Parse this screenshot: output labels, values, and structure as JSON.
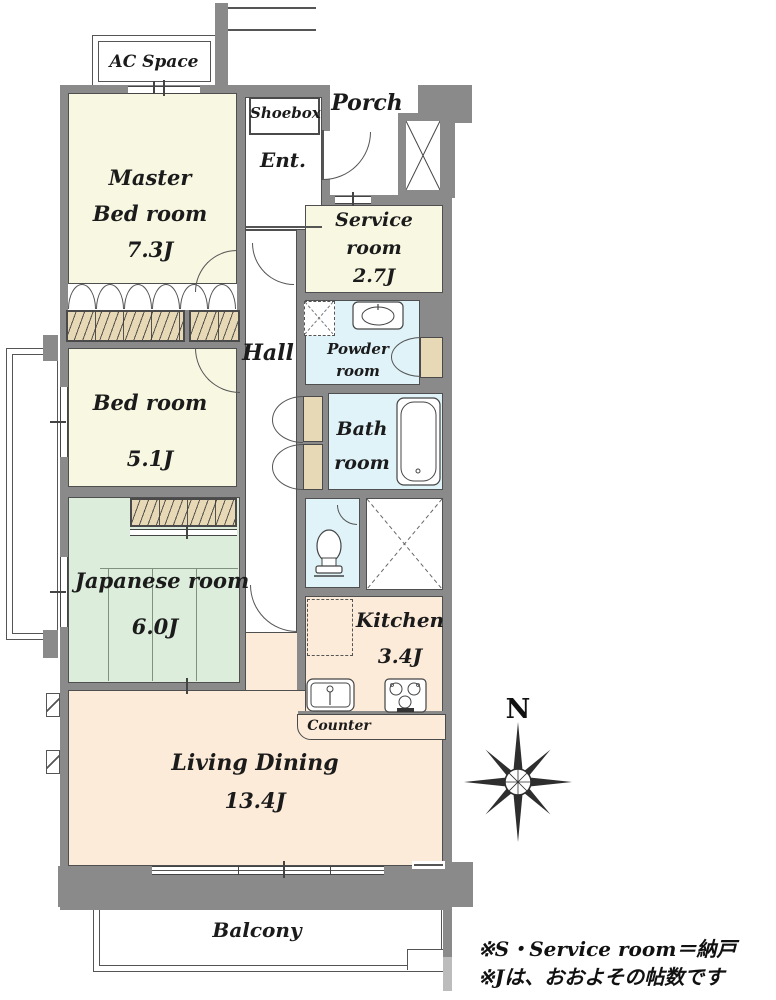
{
  "rooms": {
    "ac_space": {
      "name": "AC Space"
    },
    "master_bedroom": {
      "name_lines": [
        "Master",
        "Bed room"
      ],
      "area": "7.3J"
    },
    "shoebox": {
      "name": "Shoebox"
    },
    "entrance": {
      "name": "Ent."
    },
    "porch": {
      "name": "Porch"
    },
    "service_room": {
      "name_lines": [
        "Service",
        "room"
      ],
      "area": "2.7J"
    },
    "hall": {
      "name": "Hall"
    },
    "powder_room": {
      "name_lines": [
        "Powder",
        "room"
      ]
    },
    "bath_room": {
      "name_lines": [
        "Bath",
        "room"
      ]
    },
    "bedroom": {
      "name": "Bed room",
      "area": "5.1J"
    },
    "japanese_room": {
      "name": "Japanese room",
      "area": "6.0J"
    },
    "kitchen": {
      "name": "Kitchen",
      "area": "3.4J"
    },
    "counter": {
      "name": "Counter"
    },
    "living_dining": {
      "name": "Living Dining",
      "area": "13.4J"
    },
    "balcony": {
      "name": "Balcony"
    }
  },
  "compass": {
    "label": "N"
  },
  "legend": {
    "lines": [
      "※S・Service room＝納戸",
      "※Jは、おおよその帖数です"
    ]
  },
  "colors": {
    "wall": "#8a8a8a",
    "room_cream": "#f8f7e2",
    "room_green": "#dceddc",
    "room_peach": "#fcebd9",
    "room_blue": "#dff3f9",
    "closet_tan": "#e7d8b6",
    "text": "#1b1b1b"
  }
}
